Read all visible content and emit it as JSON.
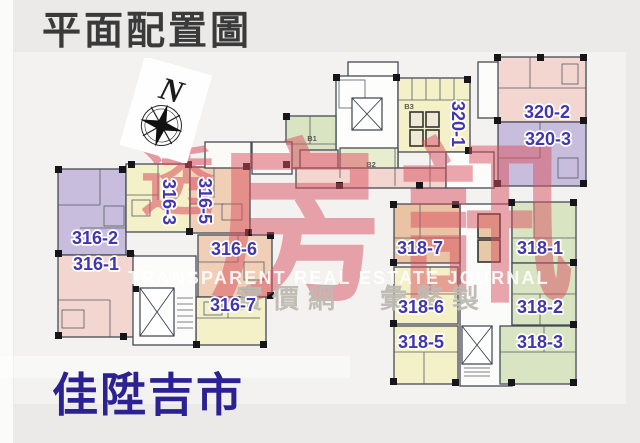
{
  "title": "平面配置圖",
  "brand": "佳陞吉市",
  "compass": {
    "north_label": "N"
  },
  "watermark": {
    "small_char": "透",
    "large_chars": "房訊",
    "latin_line": "TRANSPARENT REAL ESTATE JOURNAL",
    "cjk_line": "實價網　彙整製",
    "red": "#d84f5e",
    "gray": "#beb8b2"
  },
  "plan": {
    "label_color": "#4136ae",
    "core_labels": [
      {
        "text": "B1"
      },
      {
        "text": "B3"
      },
      {
        "text": "B2"
      }
    ],
    "palette": {
      "pink": "#f3d6cf",
      "purple": "#c8bddc",
      "yellow": "#f4f0c8",
      "peach": "#f0cfb6",
      "green": "#d9e5c2"
    },
    "units": [
      {
        "label": "316-2",
        "color": "#c8bddc",
        "orientation": "horizontal"
      },
      {
        "label": "316-1",
        "color": "#f3d6cf",
        "orientation": "horizontal"
      },
      {
        "label": "316-3",
        "color": "#f4f0c8",
        "orientation": "vertical"
      },
      {
        "label": "316-5",
        "color": "#f0cfb6",
        "orientation": "vertical"
      },
      {
        "label": "316-6",
        "color": "#f0cfb6",
        "orientation": "horizontal"
      },
      {
        "label": "316-7",
        "color": "#f4f0c8",
        "orientation": "horizontal"
      },
      {
        "label": "320-1",
        "color": "#f4f0c8",
        "orientation": "vertical"
      },
      {
        "label": "320-2",
        "color": "#f3d6cf",
        "orientation": "horizontal"
      },
      {
        "label": "320-3",
        "color": "#c8bddc",
        "orientation": "horizontal"
      },
      {
        "label": "318-7",
        "color": "#eac2a4",
        "orientation": "horizontal"
      },
      {
        "label": "318-1",
        "color": "#d9e5c2",
        "orientation": "horizontal"
      },
      {
        "label": "318-6",
        "color": "#f4f0c8",
        "orientation": "horizontal"
      },
      {
        "label": "318-2",
        "color": "#d9e5c2",
        "orientation": "horizontal"
      },
      {
        "label": "318-5",
        "color": "#f4f0c8",
        "orientation": "horizontal"
      },
      {
        "label": "318-3",
        "color": "#d9e5c2",
        "orientation": "horizontal"
      }
    ]
  }
}
